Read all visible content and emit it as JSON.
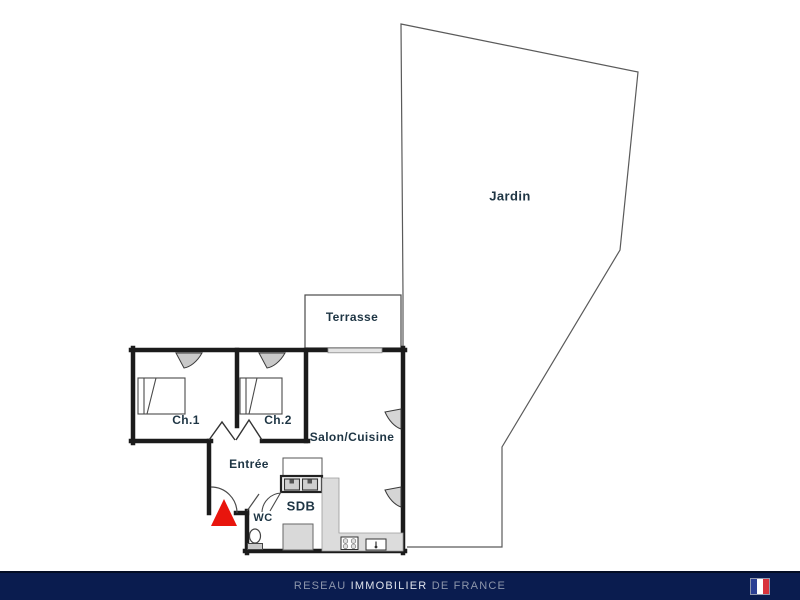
{
  "plan": {
    "type": "apartment-floor-plan",
    "labels": {
      "jardin": "Jardin",
      "terrasse": "Terrasse",
      "ch1": "Ch.1",
      "ch2": "Ch.2",
      "salon_cuisine": "Salon/Cuisine",
      "entree": "Entrée",
      "sdb": "SDB",
      "wc": "WC"
    },
    "colors": {
      "wall": "#1b1b1b",
      "thin_line": "#4a4a4a",
      "label_text": "#1e3544",
      "entrance_marker": "#e8150d",
      "counter_fill": "#dcdcdc",
      "fixture_fill": "#cfcfcf"
    }
  },
  "footer": {
    "brand_prefix": "RESEAU",
    "brand_main": "IMMOBILIER",
    "brand_suffix": "DE FRANCE",
    "background": "#0a1c4f",
    "flag": {
      "blue": "#2b3f93",
      "white": "#ffffff",
      "red": "#d8333c"
    }
  }
}
